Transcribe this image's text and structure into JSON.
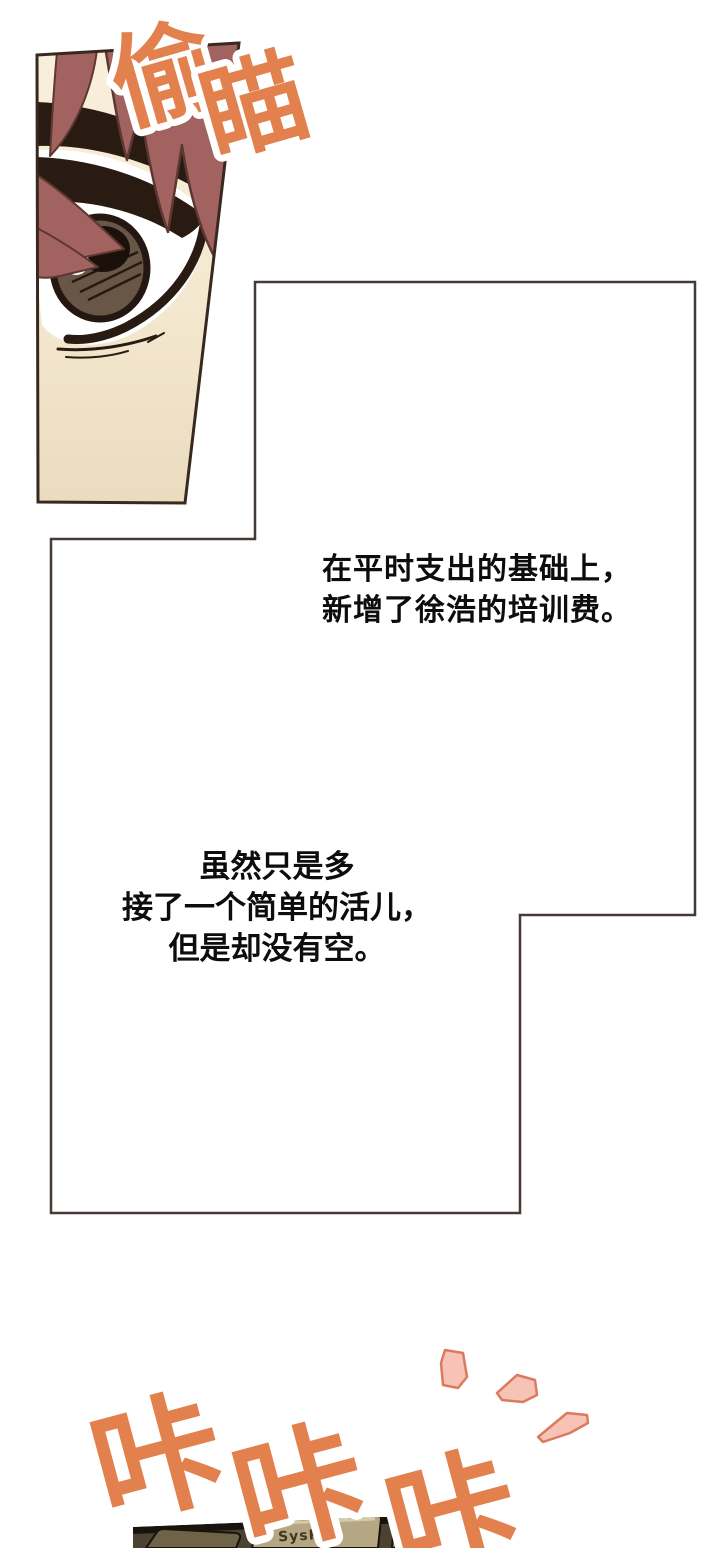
{
  "page": {
    "type": "comic-page",
    "background": "#ffffff"
  },
  "sfx": {
    "peek": {
      "text": "偷瞄",
      "chars": [
        "偷",
        "瞄"
      ],
      "fill": "#e2814e",
      "outline": "#ffffff"
    },
    "typing": {
      "text": "咔咔咔",
      "chars": [
        "咔",
        "咔",
        "咔"
      ],
      "fill": "#e2814e",
      "outline": "#ffffff"
    }
  },
  "narration": {
    "block1": {
      "lines": [
        "在平时支出的基础上，",
        "新增了徐浩的培训费。"
      ]
    },
    "block2": {
      "lines": [
        "虽然只是多",
        "接了一个简单的活儿，",
        "但是却没有空。"
      ]
    }
  },
  "keyboard": {
    "key_label": "SysRq"
  },
  "colors": {
    "sfx_orange": "#e2814e",
    "emphasis_fill": "#f6c3b6",
    "emphasis_stroke": "#db7a5c",
    "panel_border": "#453a36",
    "hair": "#a26360",
    "hair_outline": "#5d3732",
    "skin_light": "#f9efdc",
    "skin_dark": "#eadbbd",
    "eyebrow": "#291b12",
    "iris": "#685646",
    "pupil": "#1b100a",
    "keyboard_key": "#b5a783",
    "narration_text": "#0d0d0d"
  }
}
